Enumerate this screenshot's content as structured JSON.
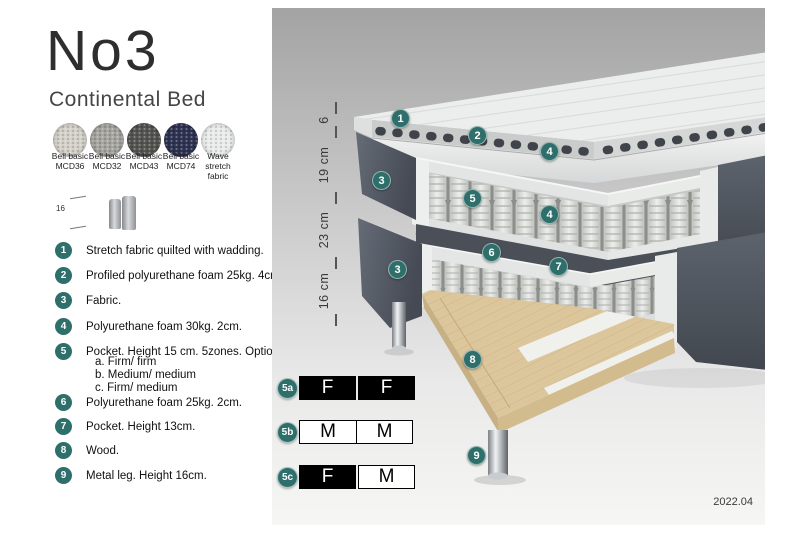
{
  "header": {
    "title": "No3",
    "subtitle": "Continental Bed"
  },
  "swatches": {
    "items": [
      {
        "line1": "Bell basic",
        "line2": "MCD36",
        "color": "#d3d0c8"
      },
      {
        "line1": "Bell basic",
        "line2": "MCD32",
        "color": "#a5a49f"
      },
      {
        "line1": "Bell basic",
        "line2": "MCD43",
        "color": "#545551"
      },
      {
        "line1": "Bell basic",
        "line2": "MCD74",
        "color": "#2e3352"
      },
      {
        "line1": "Wave",
        "line2": "stretch fabric",
        "color": "#e9ebeb"
      }
    ]
  },
  "leg_detail": {
    "dimension": "16"
  },
  "legend": {
    "items": [
      {
        "num": "1",
        "text": "Stretch fabric quilted with wadding."
      },
      {
        "num": "2",
        "text": "Profiled polyurethane foam 25kg. 4cm."
      },
      {
        "num": "3",
        "text": "Fabric."
      },
      {
        "num": "4",
        "text": "Polyurethane foam 30kg. 2cm."
      },
      {
        "num": "5",
        "text": "Pocket. Height 15 cm. 5zones. Option:",
        "options": [
          "a. Firm/ firm",
          "b. Medium/ medium",
          "c. Firm/ medium"
        ]
      },
      {
        "num": "6",
        "text": "Polyurethane foam 25kg. 2cm."
      },
      {
        "num": "7",
        "text": "Pocket. Height 13cm."
      },
      {
        "num": "8",
        "text": "Wood."
      },
      {
        "num": "9",
        "text": "Metal leg. Height 16cm."
      }
    ]
  },
  "diagram": {
    "accent": "#2e6f6b",
    "background_top": "#a3a3a3",
    "background_bottom": "#f6f6f4",
    "dimensions": [
      {
        "label": "6"
      },
      {
        "label": "19 cm"
      },
      {
        "label": "23 cm"
      },
      {
        "label": "16 cm"
      }
    ],
    "callouts": [
      "1",
      "2",
      "3",
      "4",
      "5",
      "6",
      "7",
      "8",
      "9"
    ],
    "materials": {
      "fabric_gray": "#565c66",
      "foam_white": "#e9ebea",
      "wood": "#dcc69c",
      "metal_leg": "#c8cbce"
    },
    "firmness_table": {
      "rows": [
        {
          "label": "5a",
          "cells": [
            {
              "text": "F",
              "filled": true
            },
            {
              "text": "F",
              "filled": true
            }
          ]
        },
        {
          "label": "5b",
          "cells": [
            {
              "text": "M",
              "filled": false
            },
            {
              "text": "M",
              "filled": false
            }
          ]
        },
        {
          "label": "5c",
          "cells": [
            {
              "text": "F",
              "filled": true
            },
            {
              "text": "M",
              "filled": false
            }
          ]
        }
      ]
    },
    "version": "2022.04"
  }
}
